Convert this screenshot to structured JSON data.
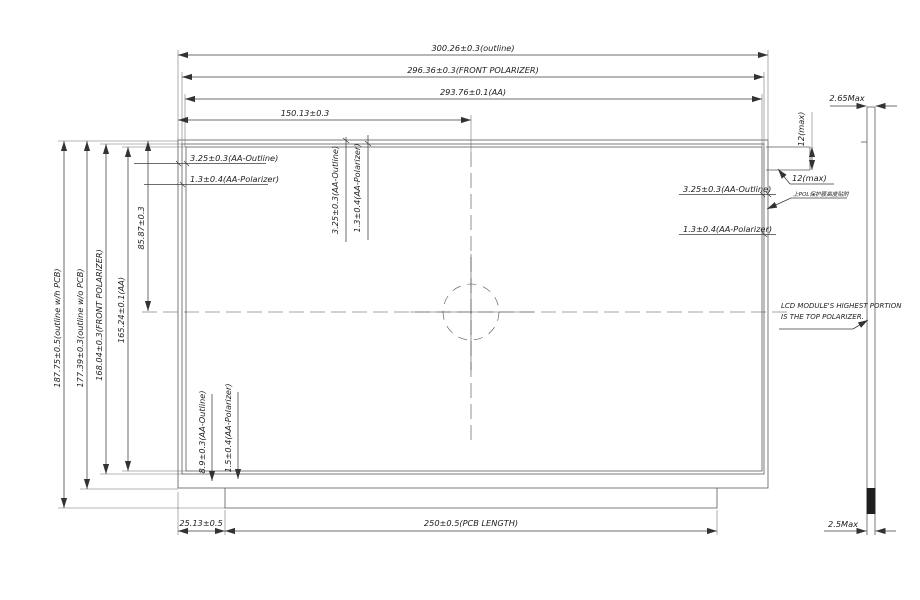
{
  "dims_top": {
    "outline": "300.26±0.3(outline)",
    "polarizer": "296.36±0.3(FRONT POLARIZER)",
    "aa": "293.76±0.1(AA)",
    "center": "150.13±0.3"
  },
  "dims_left": {
    "outline_with_pcb": "187.75±0.5(outline w/h PCB)",
    "outline_without_pcb": "177.39±0.3(outline w/o PCB)",
    "polarizer": "168.04±0.3(FRONT POLARIZER)",
    "aa": "165.24±0.1(AA)",
    "center": "85.87±0.3"
  },
  "dims_bottom": {
    "pcb_offset": "25.13±0.5",
    "pcb_length": "250±0.5(PCB LENGTH)"
  },
  "margins": {
    "top_left_outline": "3.25±0.3(AA-Outline)",
    "top_left_polarizer": "1.3±0.4(AA-Polarizer)",
    "top_center_outline": "3.25±0.3(AA-Outline)",
    "top_center_polarizer": "1.3±0.4(AA-Polarizer)",
    "right_outline": "3.25±0.3(AA-Outline)",
    "right_polarizer": "1.3±0.4(AA-Polarizer)",
    "bottom_outline": "8.9±0.3(AA-Outline)",
    "bottom_polarizer": "1.5±0.4(AA-Polarizer)"
  },
  "side_view": {
    "thickness_top": "2.65Max",
    "thickness_bottom": "2.5Max",
    "note_line1": "LCD MODULE'S HIGHEST PORTION",
    "note_line2": "IS THE TOP POLARIZER."
  },
  "tab": {
    "height_vertical": "12(max)",
    "width_horizontal": "12(max)",
    "note_cn": "上POL保护膜高度贴附"
  }
}
